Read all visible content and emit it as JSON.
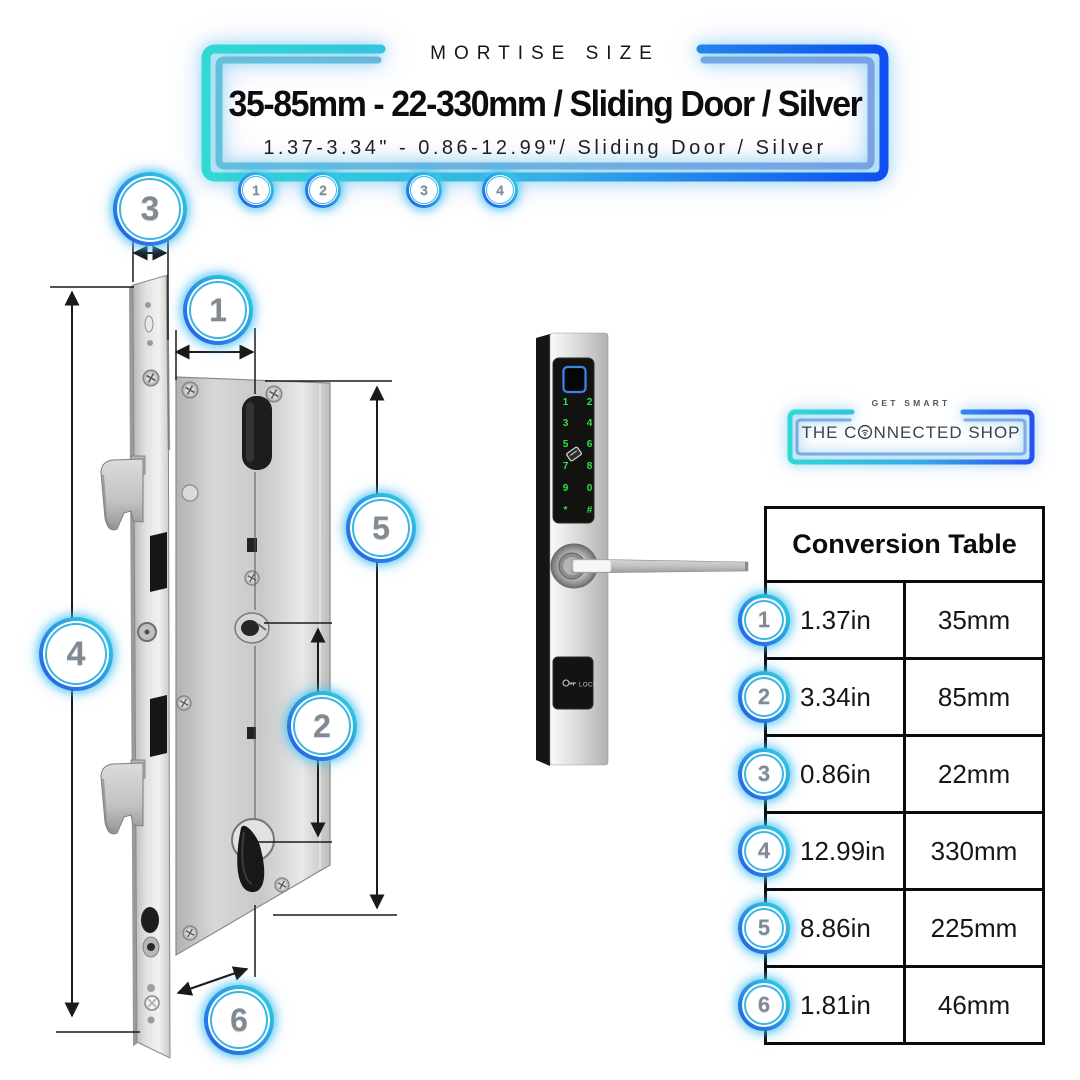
{
  "header": {
    "eyebrow": "MORTISE SIZE",
    "title": "35-85mm - 22-330mm / Sliding Door / Silver",
    "subtitle": "1.37-3.34\" - 0.86-12.99\"/ Sliding Door / Silver",
    "badges": [
      "1",
      "2",
      "3",
      "4"
    ]
  },
  "diagram": {
    "callouts": [
      "3",
      "1",
      "5",
      "4",
      "2",
      "6"
    ]
  },
  "product": {
    "keypad": [
      [
        "1",
        "2"
      ],
      [
        "3",
        "4"
      ],
      [
        "5",
        "6"
      ],
      [
        "7",
        "8"
      ],
      [
        "9",
        "0"
      ],
      [
        "*",
        "#"
      ]
    ],
    "lock_label": "LOCK"
  },
  "logo": {
    "tagline": "GET SMART",
    "name": "THE CONNECTED SHOP",
    "name_part1": "THE C",
    "name_part2": "NNECTED SHOP"
  },
  "table": {
    "title": "Conversion Table",
    "rows": [
      {
        "badge": "1",
        "inches": "1.37in",
        "mm": "35mm"
      },
      {
        "badge": "2",
        "inches": "3.34in",
        "mm": "85mm"
      },
      {
        "badge": "3",
        "inches": "0.86in",
        "mm": "22mm"
      },
      {
        "badge": "4",
        "inches": "12.99in",
        "mm": "330mm"
      },
      {
        "badge": "5",
        "inches": "8.86in",
        "mm": "225mm"
      },
      {
        "badge": "6",
        "inches": "1.81in",
        "mm": "46mm"
      }
    ]
  },
  "colors": {
    "accent_cyan": "#2fd9e2",
    "accent_blue": "#1f5be8",
    "callout_number": "#82898f",
    "keypad_green": "#2fe34a",
    "fingerprint_blue": "#3f84e8",
    "table_border": "#0a0a0a"
  }
}
